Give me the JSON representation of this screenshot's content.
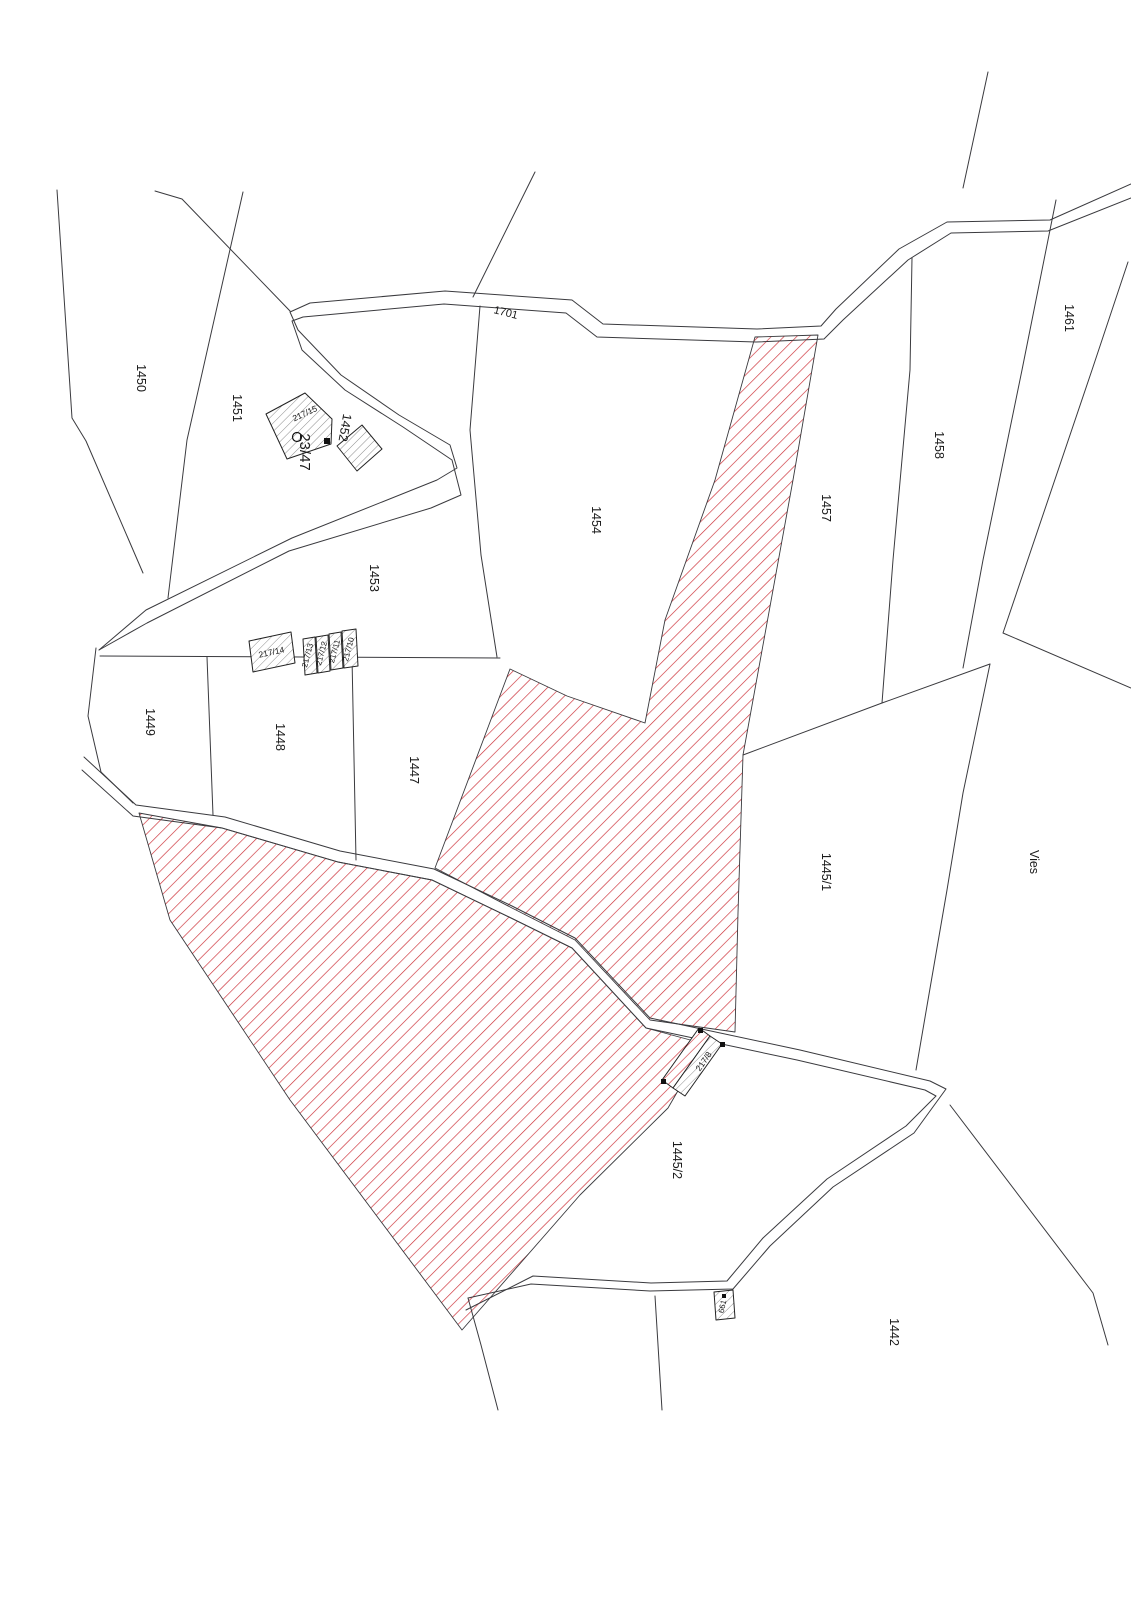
{
  "map_type": "cadastral parcel map",
  "parcels": [
    "1450",
    "1451",
    "1452",
    "1453",
    "1454",
    "1457",
    "1458",
    "1461",
    "1449",
    "1448",
    "1447",
    "1445/1",
    "1445/2",
    "1442"
  ],
  "zones": [
    "Vies"
  ],
  "roads": [
    "1701"
  ],
  "buildings": [
    "217/15",
    "217/14",
    "217/13",
    "217/12",
    "217/11",
    "217/10",
    "217/8",
    "661"
  ],
  "survey_points": [
    "23/47"
  ],
  "colors": {
    "hatch_red": "#cc2b33",
    "boundary_line": "#3a3a3e",
    "building_hatch": "#808080",
    "background": "#ffffff",
    "text": "#1a1a1a"
  }
}
